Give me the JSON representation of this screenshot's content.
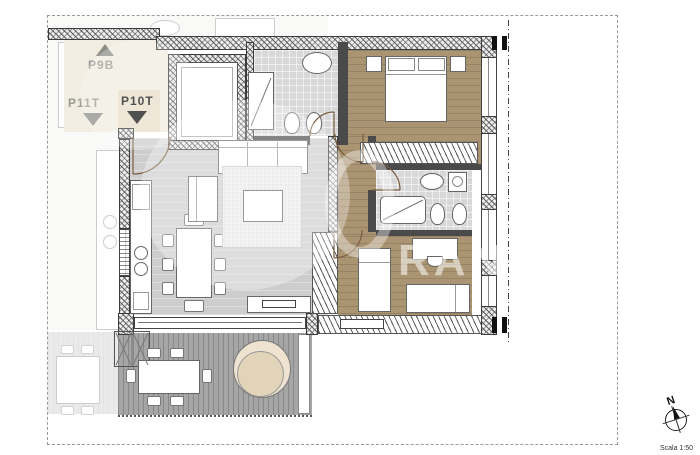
{
  "plan": {
    "units": {
      "p9b_label": "P9B",
      "p11t_label": "P11T",
      "p10t_label": "P10T"
    },
    "compass_north_label": "N",
    "scale_label": "Scala 1:50",
    "watermark_text": "RAN",
    "colors": {
      "wood_floor": "#ab9472",
      "living_floor": "#cdcdcd",
      "tile_floor": "#d8d8da",
      "deck_floor": "#a6a6a6",
      "landing_floor": "#f1ede1",
      "entry_highlight": "#e8dfca",
      "wall_dark": "#3c3c3c",
      "door_arc": "#7a5c3e",
      "tree_fill": "#ede3d0"
    }
  }
}
